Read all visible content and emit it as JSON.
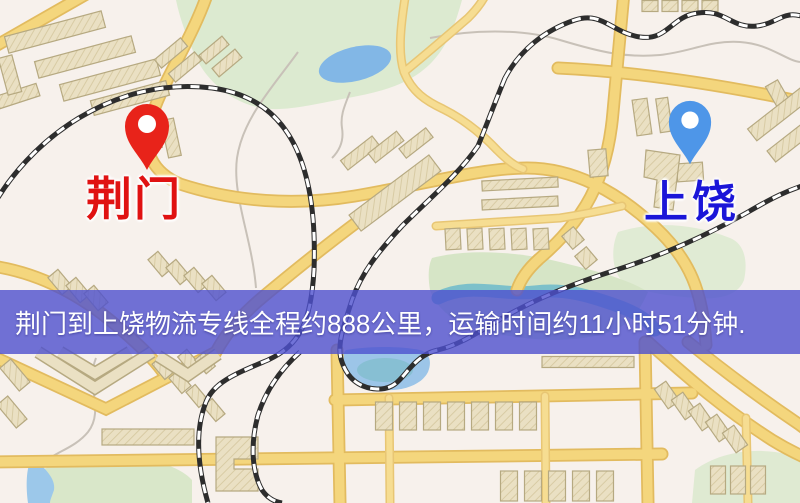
{
  "banner": {
    "text": "荆门到上饶物流专线全程约888公里，运输时间约11小时51分钟.",
    "distance_km": "888",
    "duration_hours": "11",
    "duration_minutes": "51",
    "background_color": "#4d50ce",
    "text_color": "#ffffff"
  },
  "map": {
    "origin": {
      "label": "荆门",
      "pin_color": "#e8231a",
      "label_color": "#e01212"
    },
    "destination": {
      "label": "上饶",
      "pin_color": "#4e96e8",
      "label_color": "#1b16d8"
    },
    "colors": {
      "background": "#f7f1ec",
      "road": "#f4d67d",
      "park": "#dcead0",
      "water": "#97c3e8",
      "railway": "#2d2d2d",
      "building": "#eae0c3"
    }
  }
}
